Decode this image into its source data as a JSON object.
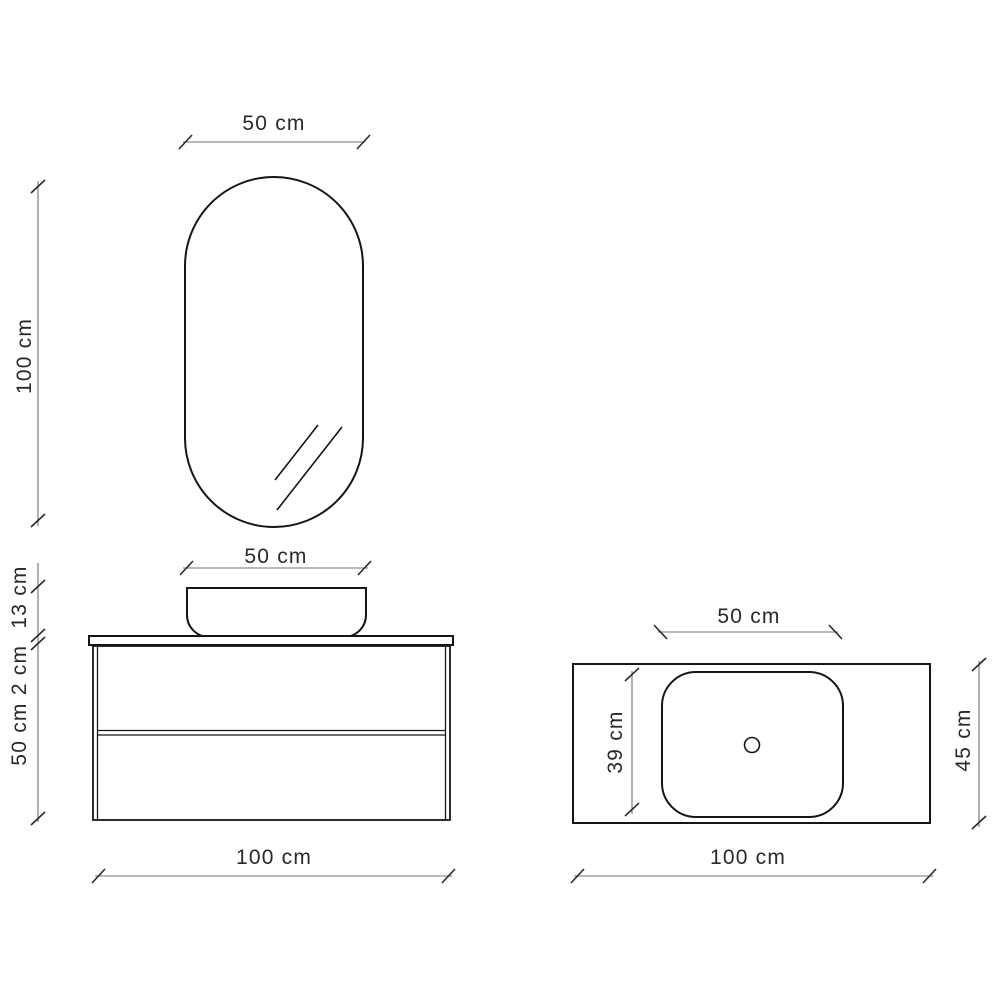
{
  "drawing": {
    "mirror_front_view": {
      "width_label": "50 cm",
      "height_label": "100 cm"
    },
    "vanity_front_view": {
      "basin_width_label": "50 cm",
      "basin_height_label": "13 cm",
      "countertop_thickness_label": "2 cm",
      "cabinet_height_label": "50 cm",
      "total_width_label": "100 cm"
    },
    "countertop_plan_view": {
      "basin_width_label": "50 cm",
      "basin_depth_label": "39 cm",
      "counter_depth_label": "45 cm",
      "counter_width_label": "100 cm"
    }
  },
  "colors": {
    "background": "#ffffff",
    "object_line": "#161616",
    "dimension_line": "#707070",
    "tick_mark": "#2a2a2a",
    "label_text": "#29292c"
  }
}
